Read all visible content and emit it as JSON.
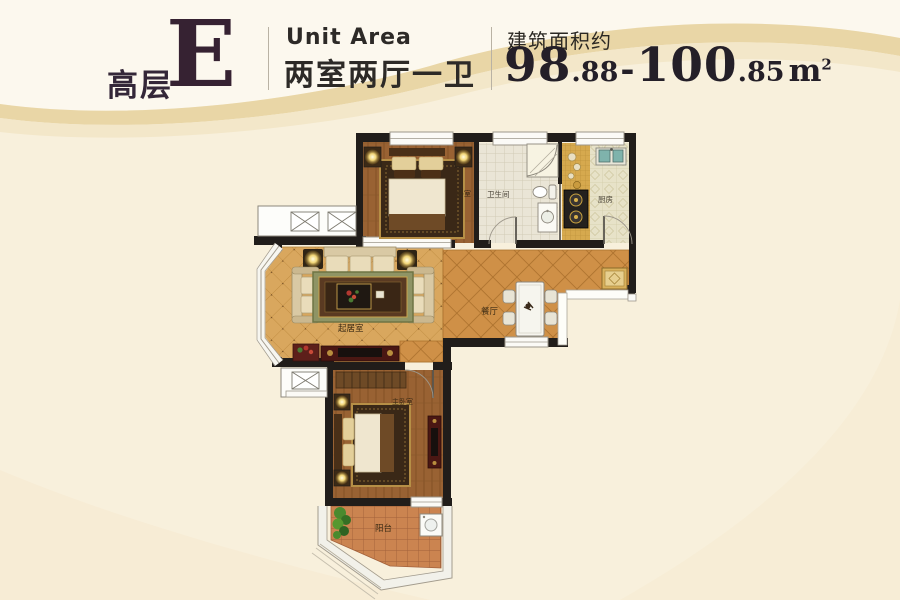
{
  "header": {
    "tier_label": "高层",
    "unit_letter": "E",
    "unit_area_en": "Unit Area",
    "unit_layout": "两室两厅一卫",
    "area_prefix": "建筑面积约",
    "area": {
      "low_int": "98",
      "low_dec": ".88",
      "sep": "-",
      "high_int": "100",
      "high_dec": ".85",
      "unit": "m",
      "unit_sup": "2",
      "full_text": "98.88-100.85㎡"
    }
  },
  "floorplan": {
    "rooms": [
      {
        "id": "bedroom",
        "label": "卧室"
      },
      {
        "id": "bathroom",
        "label": "卫生间"
      },
      {
        "id": "kitchen",
        "label": "厨房"
      },
      {
        "id": "living-room",
        "label": "起居室"
      },
      {
        "id": "dining-room",
        "label": "餐厅"
      },
      {
        "id": "master-bedroom",
        "label": "主卧室"
      },
      {
        "id": "balcony",
        "label": "阳台"
      }
    ],
    "colors": {
      "wall": "#211d1a",
      "wood_floor": "#9a6434",
      "living_floor": "#d9a75e",
      "dining_floor": "#cf9047",
      "balcony_floor": "#cb8450",
      "accent_gold": "#e3cf9a"
    }
  }
}
